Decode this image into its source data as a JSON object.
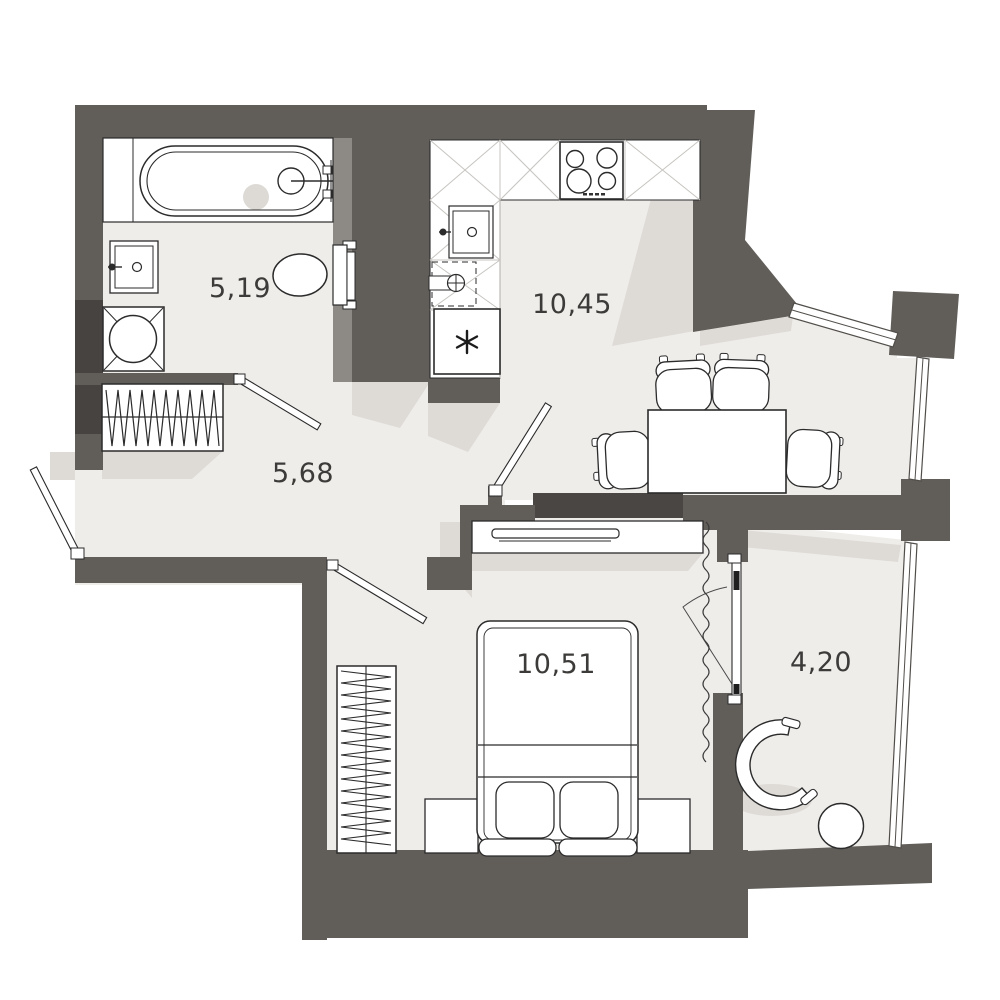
{
  "document": {
    "type": "apartment-floor-plan"
  },
  "rooms": [
    {
      "id": "bathroom",
      "area": "5,19"
    },
    {
      "id": "kitchen-living",
      "area": "10,45"
    },
    {
      "id": "hallway",
      "area": "5,68"
    },
    {
      "id": "bedroom",
      "area": "10,51"
    },
    {
      "id": "balcony",
      "area": "4,20"
    }
  ],
  "colors": {
    "wall": "#615e5a",
    "wall_dark": "#474340",
    "partition": "#4a4643",
    "shaft": "#8d8a85",
    "floor": "#efedea",
    "shadow": "#dedbd7",
    "outline": "#2b2b2b",
    "hatch": "#c7c4c0",
    "label_text": "#3d3b39"
  },
  "fixtures": [
    "bathtub",
    "bathroom-sink",
    "toilet",
    "washing-machine",
    "kitchen-counter",
    "stove",
    "kitchen-sink",
    "dishwasher",
    "refrigerator",
    "dining-table",
    "dining-chairs",
    "hallway-wardrobe",
    "tv-console",
    "tv",
    "bed",
    "pillows",
    "nightstands",
    "bedroom-wardrobe",
    "armchair",
    "side-table",
    "curtain",
    "doors",
    "windows"
  ]
}
